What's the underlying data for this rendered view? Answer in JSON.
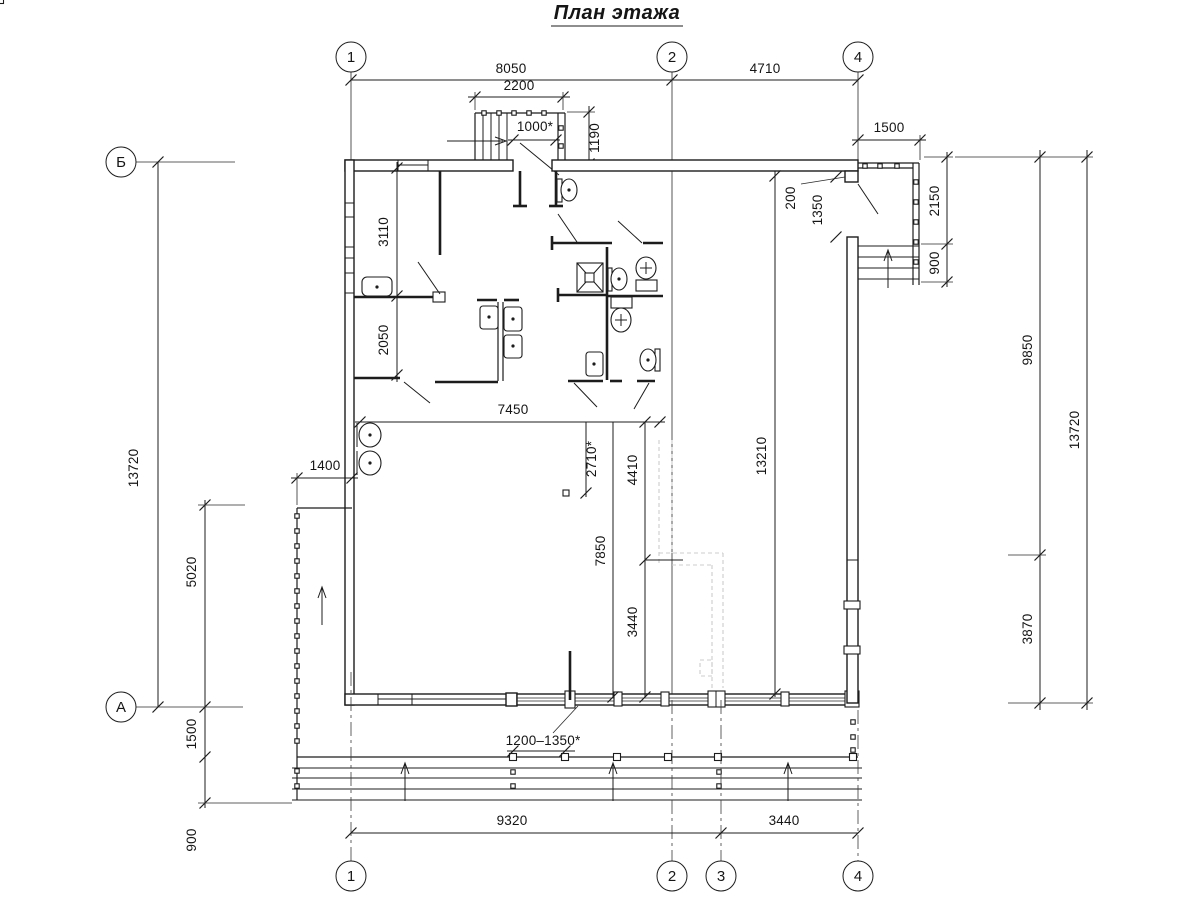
{
  "title": "План этажа",
  "axes": {
    "top_1": "1",
    "top_2": "2",
    "top_4": "4",
    "left_b": "Б",
    "left_a": "А",
    "bottom_1": "1",
    "bottom_2": "2",
    "bottom_3": "3",
    "bottom_4": "4"
  },
  "dims": {
    "top_8050": "8050",
    "top_4710": "4710",
    "top_2200": "2200",
    "door_1000": "1000*",
    "vest_1190": "1190",
    "porch_1500": "1500",
    "left_3110": "3110",
    "left_2050": "2050",
    "left_13720": "13720",
    "left_1400": "1400",
    "left_5020": "5020",
    "left_1500": "1500",
    "left_900": "900",
    "hall_7450": "7450",
    "hall_2710": "2710*",
    "hall_4410": "4410",
    "hall_7850": "7850",
    "hall_3440": "3440",
    "hall_13210": "13210",
    "corner_200": "200",
    "corner_1350": "1350",
    "right_2150": "2150",
    "right_900": "900",
    "right_9850": "9850",
    "right_3870": "3870",
    "right_13720": "13720",
    "bottom_span": "1200–1350*",
    "bottom_9320": "9320",
    "bottom_3440": "3440"
  }
}
